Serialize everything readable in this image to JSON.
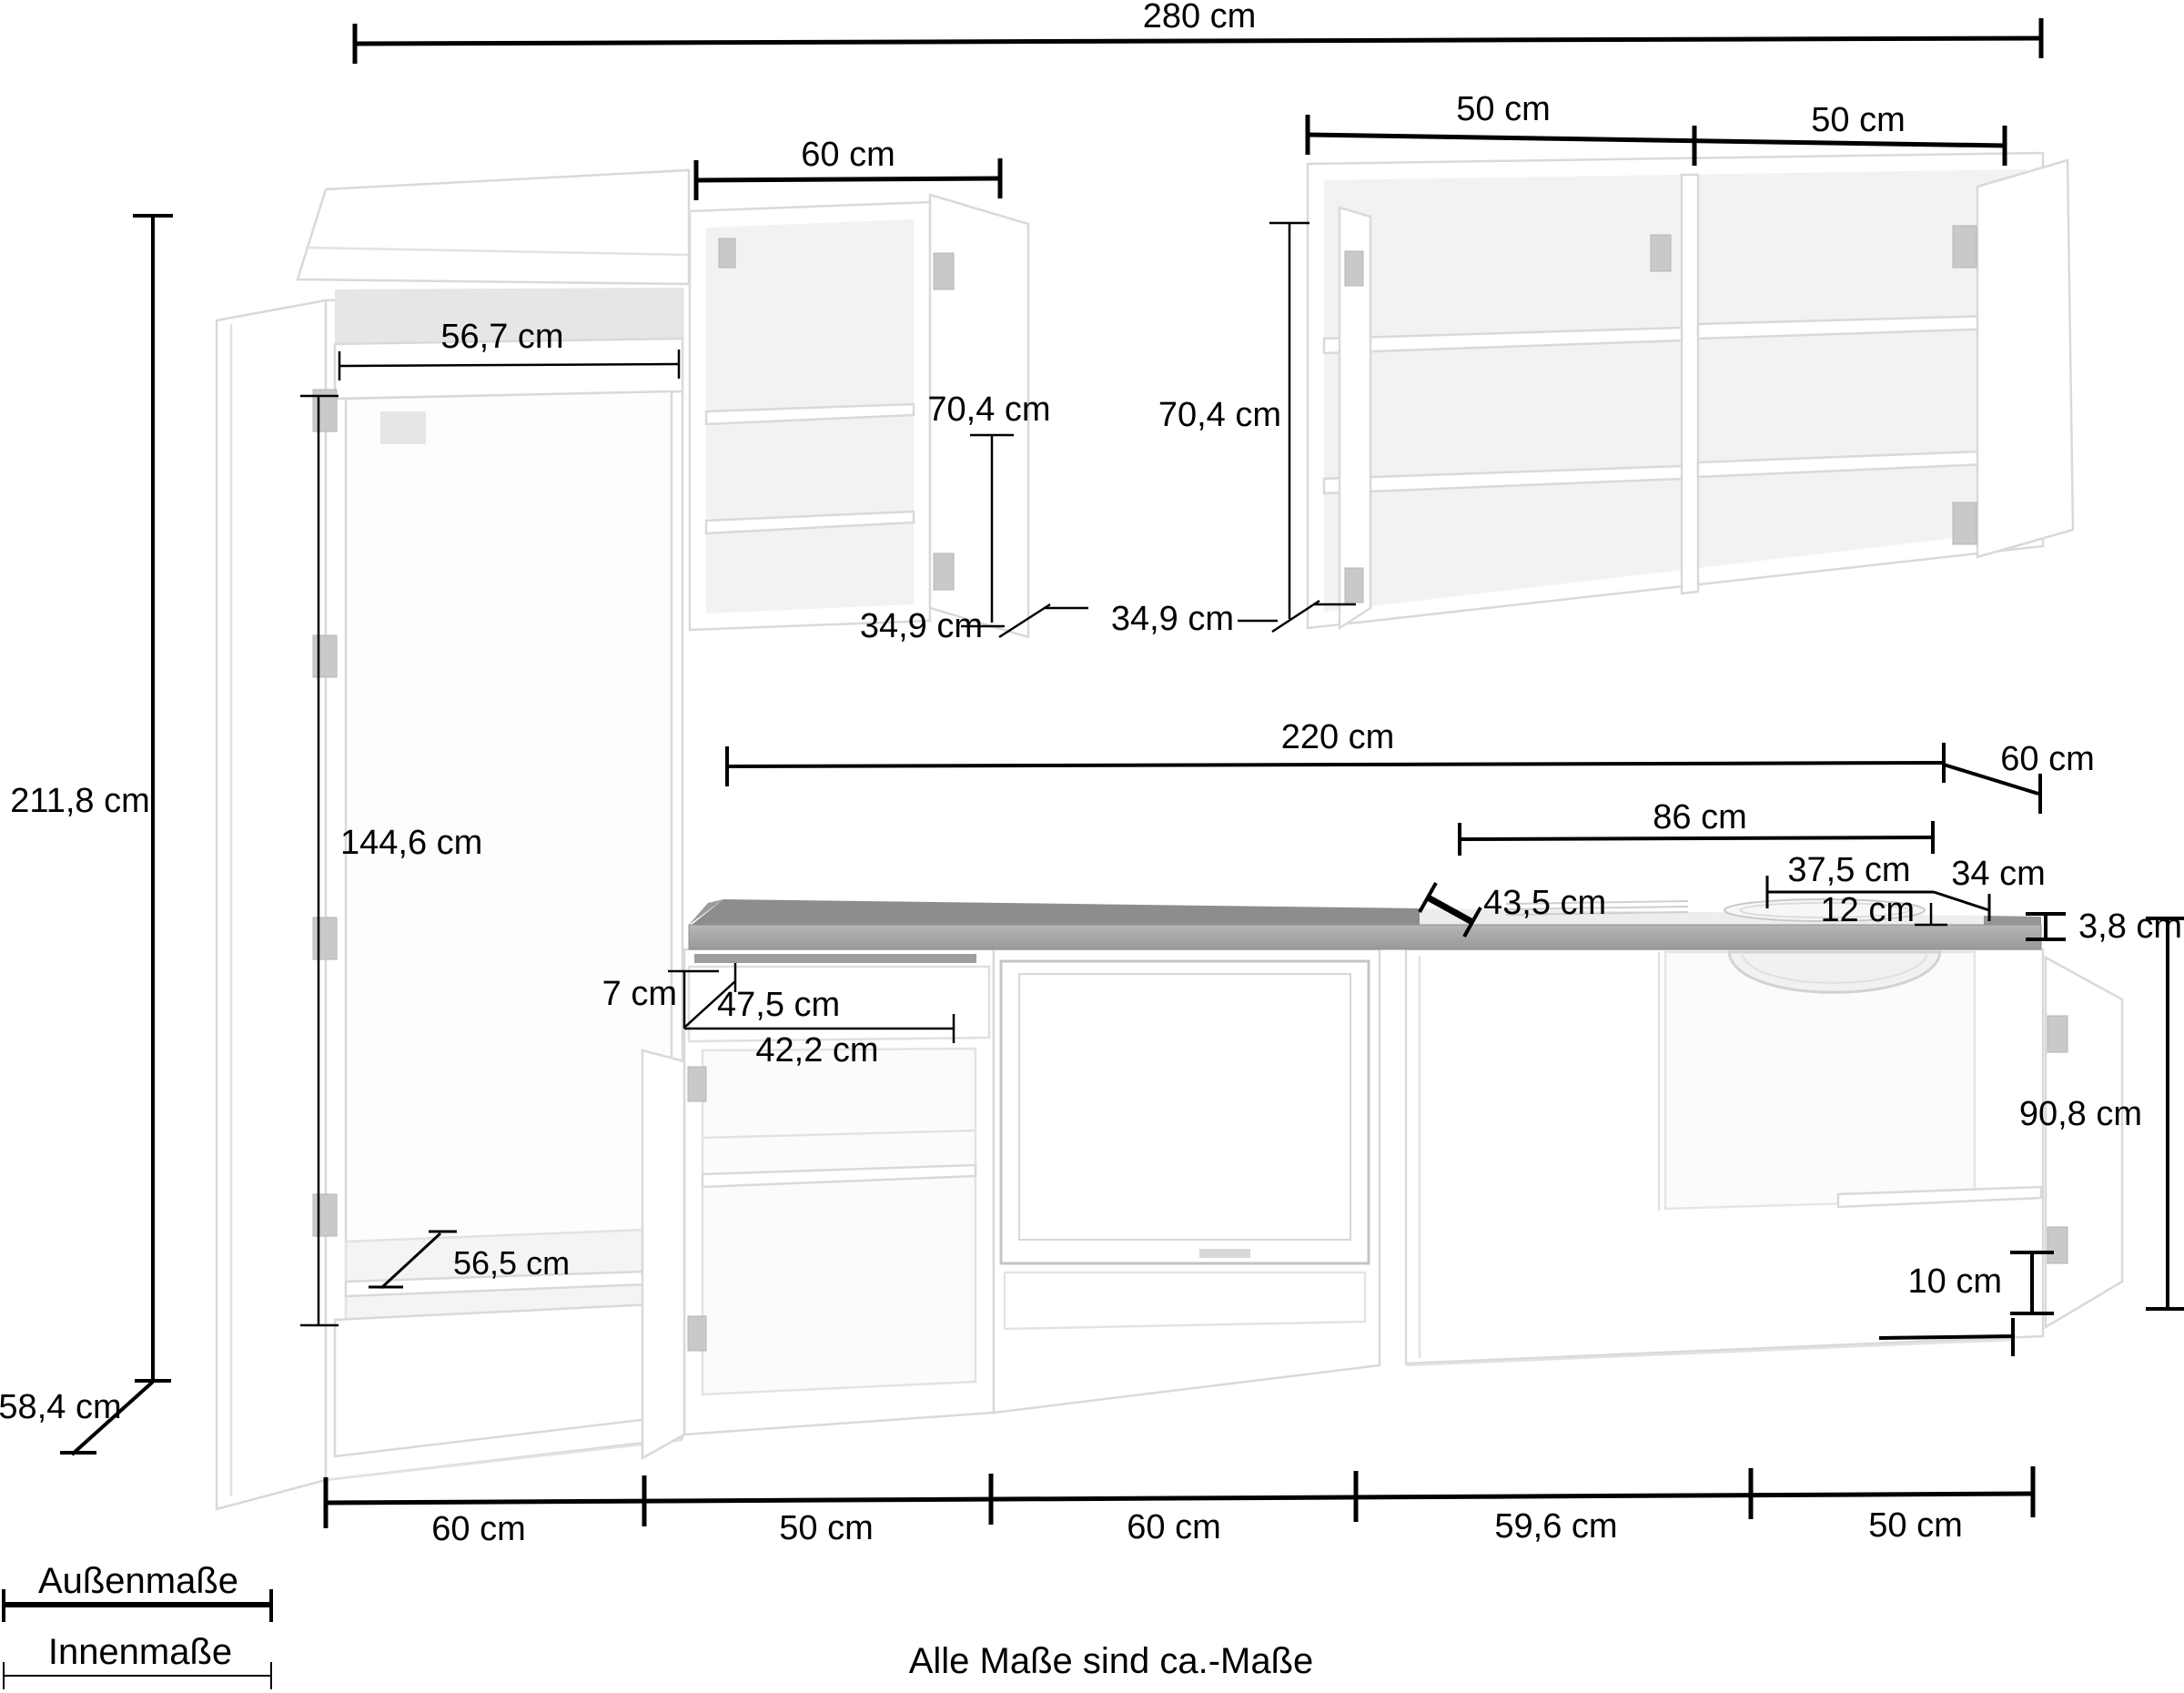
{
  "dims": {
    "total_width": "280 cm",
    "wall_cabinet_left_width": "60 cm",
    "wall_cabinet_right_width_1": "50 cm",
    "wall_cabinet_right_width_2": "50 cm",
    "tall_cabinet_inner_width": "56,7 cm",
    "wall_cabinet_left_inner_height": "70,4 cm",
    "wall_cabinet_left_inner_depth": "34,9 cm",
    "wall_cabinet_right_inner_height": "70,4 cm",
    "wall_cabinet_right_inner_depth": "34,9 cm",
    "total_height": "211,8 cm",
    "tall_cabinet_inner_height": "144,6 cm",
    "worktop_run_width": "220 cm",
    "worktop_depth": "60 cm",
    "hob_section_width": "86 cm",
    "hob_section_depth": "43,5 cm",
    "sink_width": "37,5 cm",
    "sink_total_depth": "34 cm",
    "sink_inner_depth": "12 cm",
    "worktop_thickness": "3,8 cm",
    "drawer_front_height": "7 cm",
    "drawer_inner_diagonal": "47,5 cm",
    "drawer_inner_width": "42,2 cm",
    "base_cabinet_inner_height": "90,8 cm",
    "plinth_height": "10 cm",
    "tall_cabinet_shelf_depth": "56,5 cm",
    "total_depth": "58,4 cm",
    "base_widths": [
      "60 cm",
      "50 cm",
      "60 cm",
      "59,6 cm",
      "50 cm"
    ]
  },
  "legend": {
    "outer_label": "Außenmaße",
    "inner_label": "Innenmaße"
  },
  "footer": {
    "note": "Alle Maße sind ca.-Maße"
  }
}
